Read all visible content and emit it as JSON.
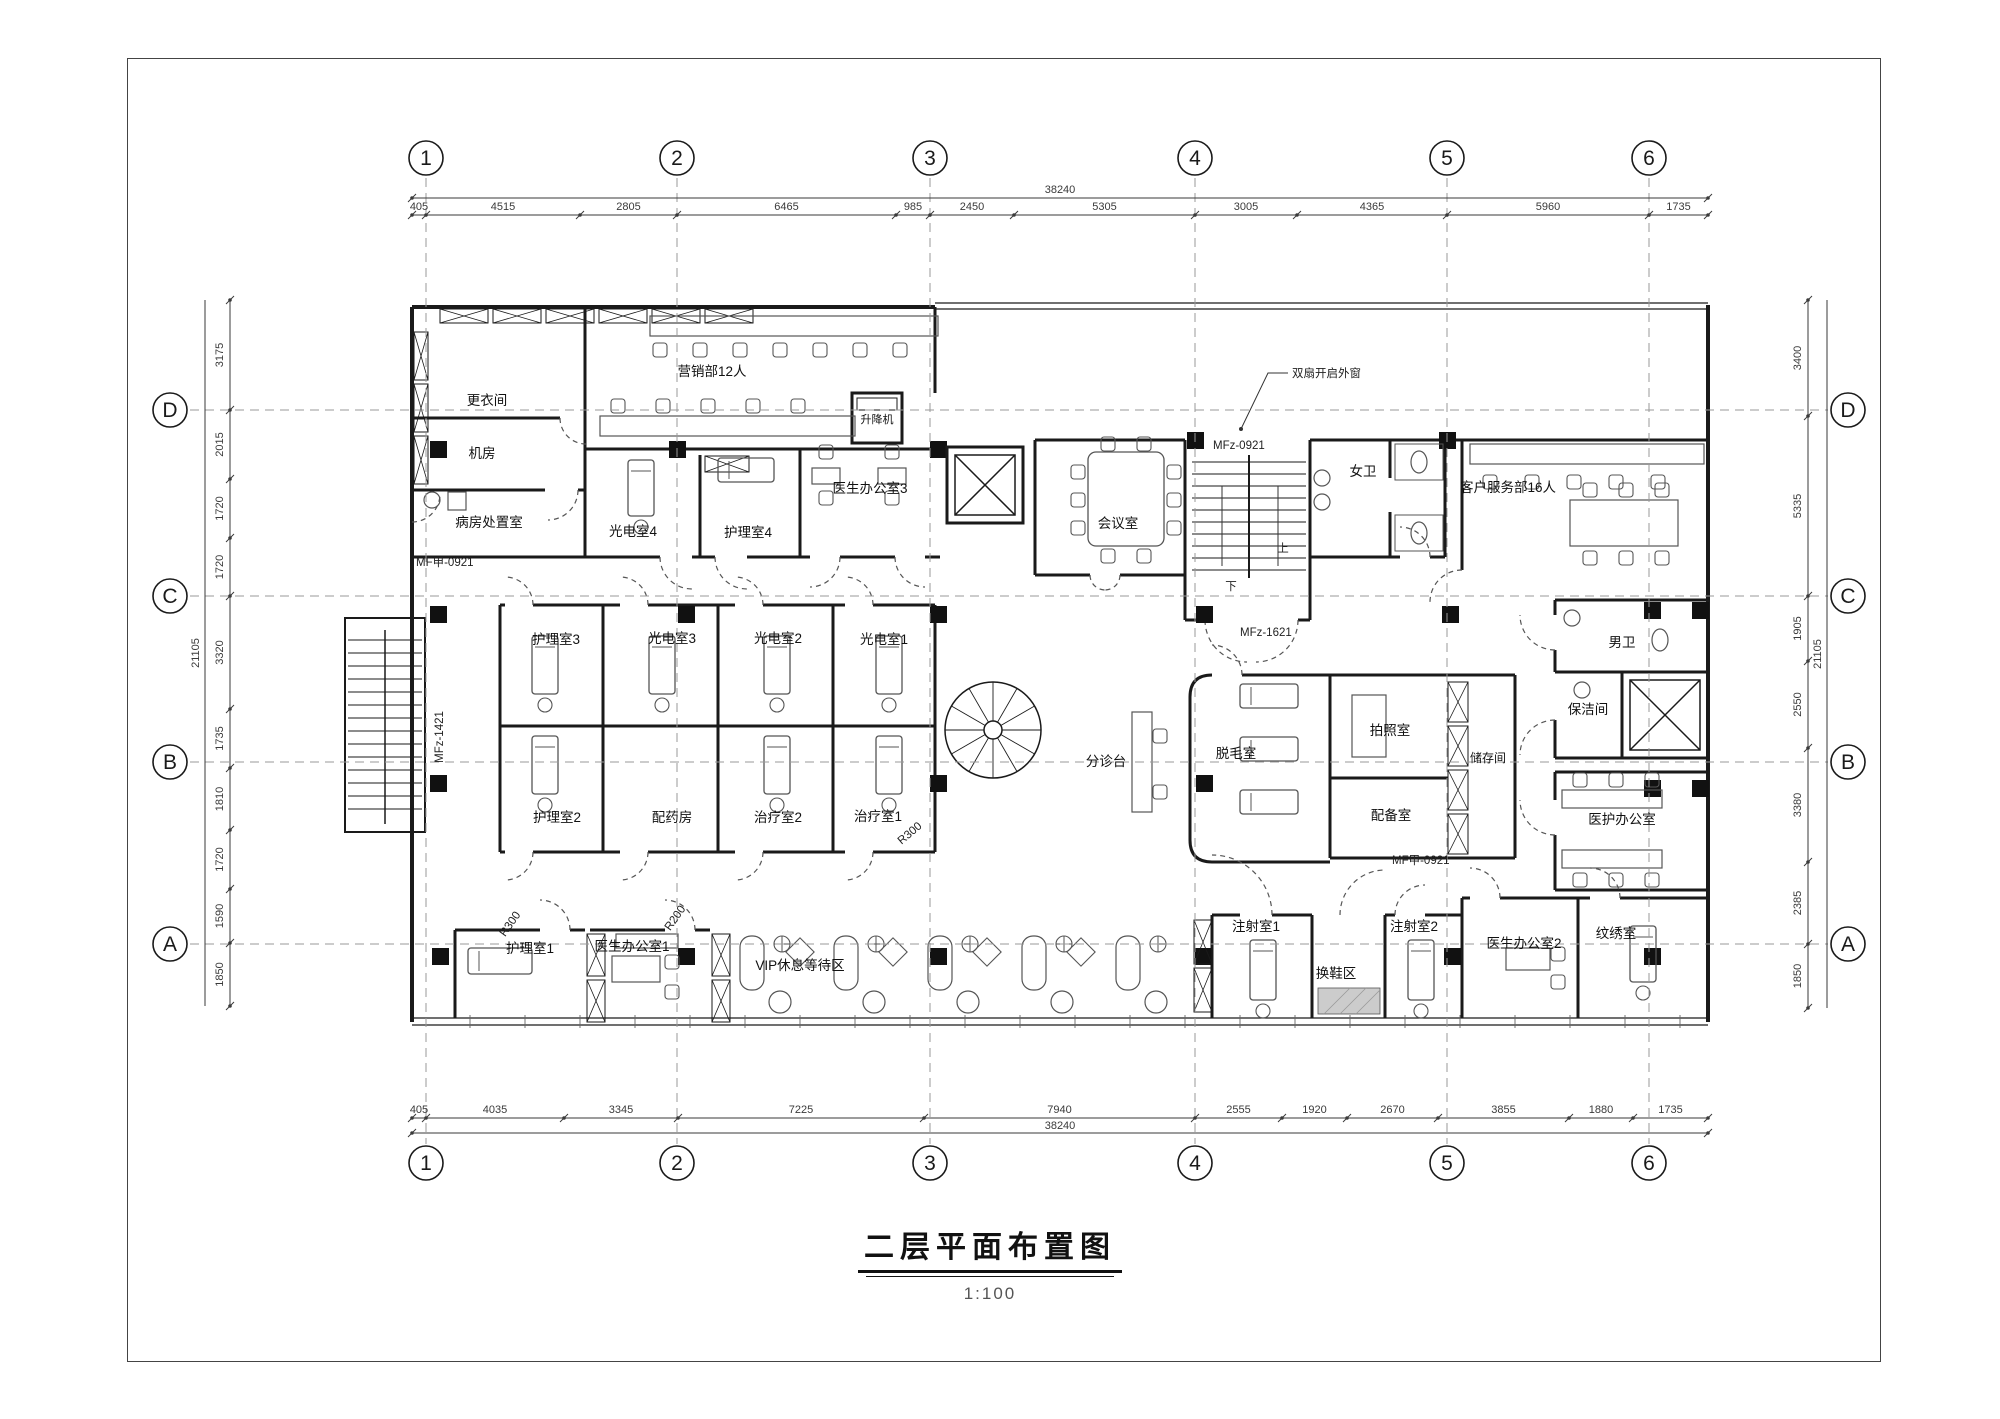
{
  "page": {
    "title": "二层平面布置图",
    "scale_label": "1:100"
  },
  "colors": {
    "line": "#1a1a1a",
    "dim": "#3a3a3a",
    "grid_dash": "#999999",
    "column_fill": "#111111",
    "furniture": "#555555"
  },
  "grid": {
    "cols": [
      {
        "label": "1",
        "x": 426
      },
      {
        "label": "2",
        "x": 677
      },
      {
        "label": "3",
        "x": 930
      },
      {
        "label": "4",
        "x": 1195
      },
      {
        "label": "5",
        "x": 1447
      },
      {
        "label": "6",
        "x": 1649
      }
    ],
    "rows": [
      {
        "label": "D",
        "y": 410
      },
      {
        "label": "C",
        "y": 596
      },
      {
        "label": "B",
        "y": 762
      },
      {
        "label": "A",
        "y": 944
      }
    ],
    "bubble": {
      "top_y": 158,
      "bottom_y": 1163,
      "left_x": 170,
      "right_x": 1848,
      "radius": 17
    },
    "line": {
      "v_y1": 178,
      "v_y2": 1144,
      "h_x1": 190,
      "h_x2": 1828
    }
  },
  "dims": {
    "top": {
      "line_y": 215,
      "total_line_y": 198,
      "label_y": 210,
      "total_label_x": 1060,
      "total_label_y": 193,
      "total": "38240",
      "ticks": [
        412,
        426,
        580,
        677,
        896,
        930,
        1014,
        1195,
        1297,
        1447,
        1649,
        1708
      ],
      "labels": [
        "405",
        "4515",
        "2805",
        "6465",
        "985",
        "2450",
        "5305",
        "3005",
        "4365",
        "5960",
        "1735"
      ]
    },
    "bottom": {
      "line_y": 1118,
      "total_line_y": 1133,
      "label_y": 1113,
      "total_label_x": 1060,
      "total_label_y": 1129,
      "total": "38240",
      "ticks": [
        412,
        426,
        564,
        678,
        924,
        1195,
        1282,
        1347,
        1438,
        1569,
        1633,
        1708
      ],
      "labels": [
        "405",
        "4035",
        "3345",
        "7225",
        "7940",
        "2555",
        "1920",
        "2670",
        "3855",
        "1880",
        "1735"
      ]
    },
    "left": {
      "line_x": 230,
      "total_line_x": 205,
      "label_x": 223,
      "total_label_x": 199,
      "total_label_y": 653,
      "total": "21105",
      "ticks": [
        300,
        410,
        479,
        538,
        596,
        709,
        768,
        830,
        889,
        943,
        1006
      ],
      "labels": [
        "3175",
        "2015",
        "1720",
        "1720",
        "3320",
        "1735",
        "1810",
        "1720",
        "1590",
        "1850"
      ]
    },
    "right": {
      "line_x": 1808,
      "total_line_x": 1827,
      "label_x": 1801,
      "total_label_x": 1821,
      "total_label_y": 654,
      "total": "21105",
      "ticks": [
        300,
        416,
        596,
        661,
        748,
        862,
        944,
        1008
      ],
      "labels": [
        "3400",
        "5335",
        "1905",
        "2550",
        "3380",
        "2385",
        "1850"
      ]
    }
  },
  "rooms": [
    {
      "label": "更衣间",
      "x": 487,
      "y": 405
    },
    {
      "label": "营销部12人",
      "x": 712,
      "y": 376
    },
    {
      "label": "升降机",
      "x": 877,
      "y": 423,
      "fs": 11
    },
    {
      "label": "机房",
      "x": 482,
      "y": 458
    },
    {
      "label": "病房处置室",
      "x": 489,
      "y": 527
    },
    {
      "label": "光电室4",
      "x": 633,
      "y": 536
    },
    {
      "label": "护理室4",
      "x": 748,
      "y": 537
    },
    {
      "label": "医生办公室3",
      "x": 870,
      "y": 493
    },
    {
      "label": "会议室",
      "x": 1118,
      "y": 528
    },
    {
      "label": "女卫",
      "x": 1363,
      "y": 476
    },
    {
      "label": "客户服务部16人",
      "x": 1508,
      "y": 492
    },
    {
      "label": "男卫",
      "x": 1622,
      "y": 647
    },
    {
      "label": "保洁间",
      "x": 1588,
      "y": 714
    },
    {
      "label": "护理室3",
      "x": 556,
      "y": 644
    },
    {
      "label": "光电室3",
      "x": 672,
      "y": 643
    },
    {
      "label": "光电室2",
      "x": 778,
      "y": 643
    },
    {
      "label": "光电室1",
      "x": 884,
      "y": 644
    },
    {
      "label": "护理室2",
      "x": 557,
      "y": 822
    },
    {
      "label": "配药房",
      "x": 672,
      "y": 822
    },
    {
      "label": "治疗室2",
      "x": 778,
      "y": 822
    },
    {
      "label": "治疗室1",
      "x": 878,
      "y": 821
    },
    {
      "label": "分诊台",
      "x": 1106,
      "y": 766
    },
    {
      "label": "脱毛室",
      "x": 1236,
      "y": 758
    },
    {
      "label": "拍照室",
      "x": 1390,
      "y": 735
    },
    {
      "label": "储存间",
      "x": 1488,
      "y": 762,
      "fs": 12
    },
    {
      "label": "配备室",
      "x": 1391,
      "y": 820
    },
    {
      "label": "医护办公室",
      "x": 1622,
      "y": 824
    },
    {
      "label": "护理室1",
      "x": 530,
      "y": 953
    },
    {
      "label": "医生办公室1",
      "x": 632,
      "y": 951
    },
    {
      "label": "VIP休息等待区",
      "x": 800,
      "y": 970
    },
    {
      "label": "注射室1",
      "x": 1256,
      "y": 931
    },
    {
      "label": "换鞋区",
      "x": 1336,
      "y": 978
    },
    {
      "label": "注射室2",
      "x": 1414,
      "y": 931
    },
    {
      "label": "医生办公室2",
      "x": 1524,
      "y": 948
    },
    {
      "label": "纹绣室",
      "x": 1616,
      "y": 938
    }
  ],
  "annotations": [
    {
      "text": "双扇开启外窗",
      "x": 1292,
      "y": 377,
      "anchor": "start",
      "leader": "1288,373 1268,373 1241,429"
    },
    {
      "text": "MF甲-0921",
      "x": 416,
      "y": 566,
      "anchor": "start"
    },
    {
      "text": "MFz-1421",
      "x": 443,
      "y": 737,
      "rotate": -90
    },
    {
      "text": "MFz-0921",
      "x": 1213,
      "y": 449,
      "anchor": "start"
    },
    {
      "text": "MFz-1621",
      "x": 1240,
      "y": 636,
      "anchor": "start"
    },
    {
      "text": "MF甲-0921",
      "x": 1392,
      "y": 864,
      "anchor": "start"
    },
    {
      "text": "R300",
      "x": 513,
      "y": 926,
      "rotate": -55
    },
    {
      "text": "R200",
      "x": 678,
      "y": 920,
      "rotate": -55
    },
    {
      "text": "R300",
      "x": 912,
      "y": 836,
      "rotate": -40
    },
    {
      "text": "下",
      "x": 1231,
      "y": 590
    },
    {
      "text": "上",
      "x": 1283,
      "y": 552
    }
  ]
}
